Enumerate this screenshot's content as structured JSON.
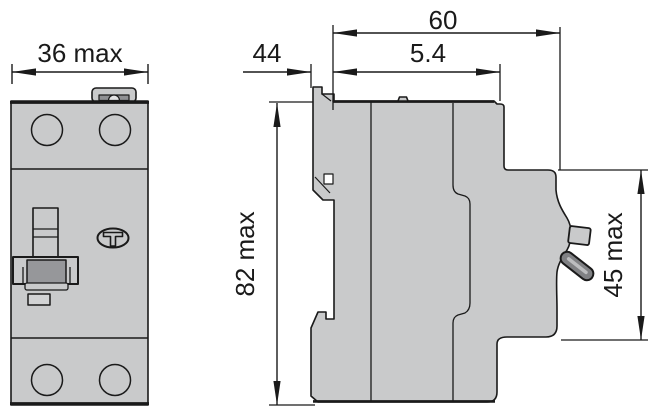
{
  "diagram": {
    "type": "technical-dimension-drawing",
    "subject": "2-module DIN-rail residual current circuit breaker, front and side views",
    "front_view": {
      "width_label": "36 max",
      "test_button_label": "T"
    },
    "side_view": {
      "total_depth_label": "60",
      "clip_depth_label": "5.4",
      "rail_depth_label": "44",
      "height_label": "82 max",
      "front_protrusion_height_label": "45 max"
    },
    "colors": {
      "body_fill": "#c9cacb",
      "dark_fill": "#96979a",
      "lever_fill": "#808184",
      "line": "#1a1a1a",
      "background": "#ffffff"
    }
  }
}
